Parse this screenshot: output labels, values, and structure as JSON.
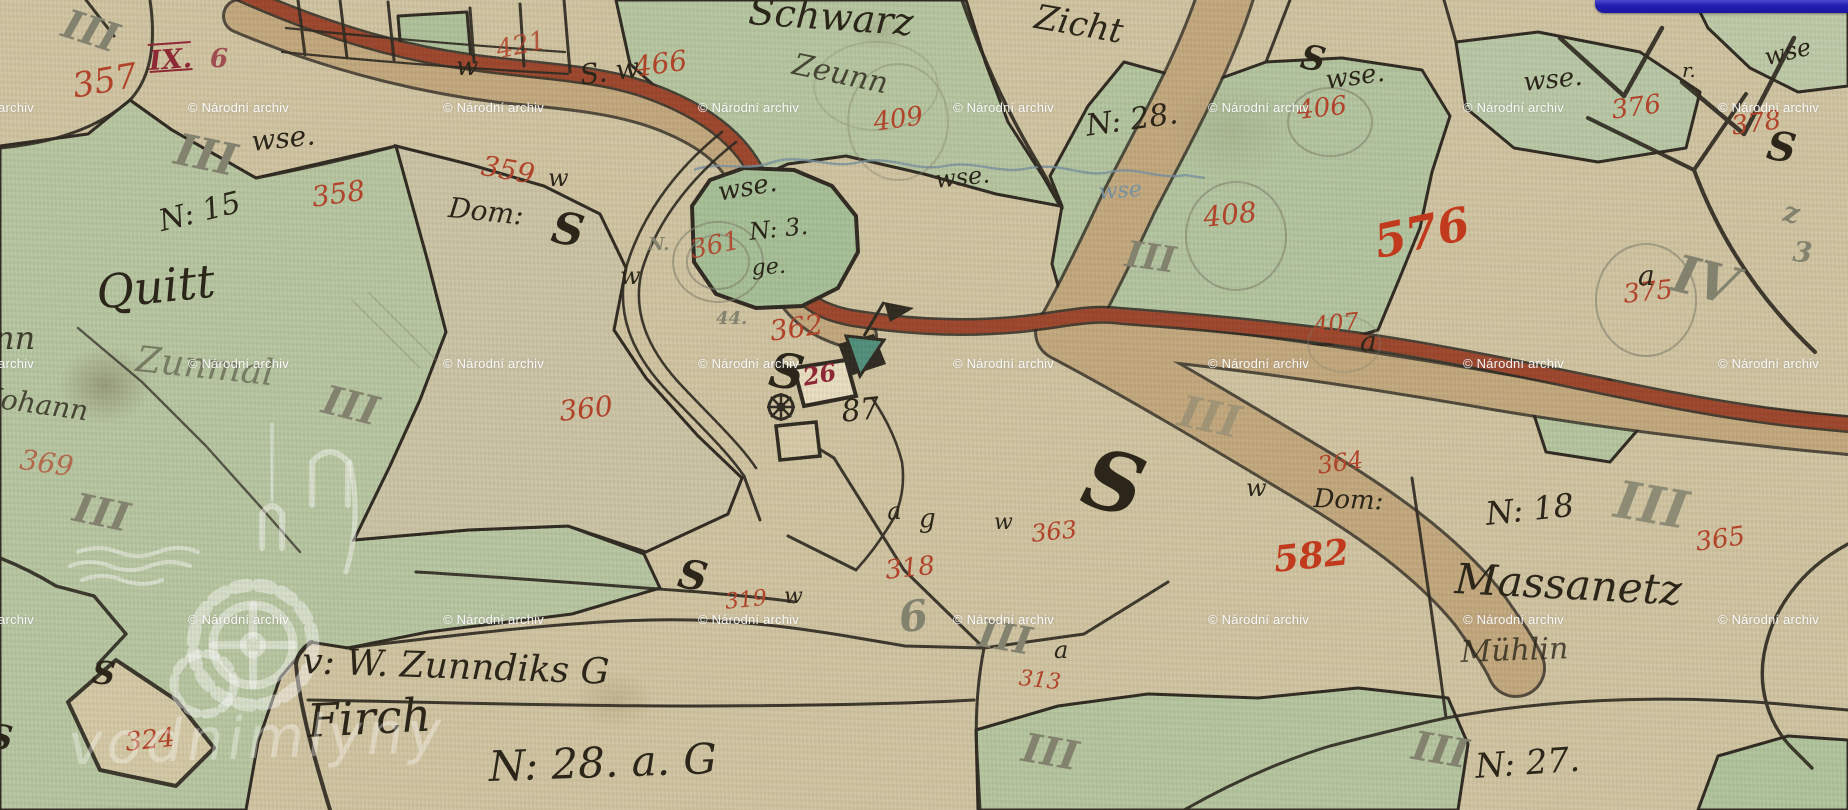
{
  "viewer": {
    "archive_watermark_text": "© Národní archiv",
    "logo_text": "vodnimlyny",
    "map_kind_note": "historic hand-drawn cadastral map sheet"
  },
  "watermark_grid": {
    "cols": [
      -67,
      188,
      443,
      698,
      953,
      1208,
      1463,
      1718
    ],
    "rows": [
      100,
      356,
      612
    ]
  },
  "colors": {
    "paper": "#d0c4a2",
    "field_green": "#b7c6a2",
    "pond_green": "#a6c098",
    "road_brick": "#9c452c",
    "road_tan": "#c2a87e",
    "ink": "#2b2619",
    "red_ink": "#b0432a",
    "bright_red_ink": "#c23a1d",
    "pencil": "#83826e",
    "stream_blue": "#76909f",
    "ui_blue_bar": "#221cae",
    "watermark_white": "#ffffff"
  },
  "map_labels": {
    "red": [
      {
        "t": "357",
        "x": 70,
        "y": 70,
        "s": 34,
        "r": -10
      },
      {
        "t": "IX.",
        "x": 148,
        "y": 48,
        "s": 27,
        "r": -4,
        "v": "dark rule"
      },
      {
        "t": "6",
        "x": 210,
        "y": 46,
        "s": 26,
        "r": 0,
        "v": "dark",
        "o": 0.75
      },
      {
        "t": "421",
        "x": 494,
        "y": 38,
        "s": 26,
        "r": -12,
        "o": 0.85
      },
      {
        "t": "466",
        "x": 632,
        "y": 54,
        "s": 28,
        "r": -8
      },
      {
        "t": "358",
        "x": 310,
        "y": 184,
        "s": 28,
        "r": -8
      },
      {
        "t": "359",
        "x": 484,
        "y": 152,
        "s": 28,
        "r": 10
      },
      {
        "t": "409",
        "x": 872,
        "y": 110,
        "s": 26,
        "r": -8
      },
      {
        "t": "406",
        "x": 1296,
        "y": 98,
        "s": 26,
        "r": -6
      },
      {
        "t": "408",
        "x": 1202,
        "y": 204,
        "s": 28,
        "r": -6
      },
      {
        "t": "361",
        "x": 688,
        "y": 238,
        "s": 26,
        "r": -12,
        "o": 0.9
      },
      {
        "t": "362",
        "x": 768,
        "y": 318,
        "s": 28,
        "r": -8
      },
      {
        "t": "360",
        "x": 558,
        "y": 398,
        "s": 28,
        "r": -6
      },
      {
        "t": "369",
        "x": 22,
        "y": 446,
        "s": 28,
        "r": 8,
        "o": 0.7
      },
      {
        "t": "576",
        "x": 1370,
        "y": 220,
        "s": 46,
        "r": -12,
        "v": "bright"
      },
      {
        "t": "407",
        "x": 1312,
        "y": 314,
        "s": 24,
        "r": -6
      },
      {
        "t": "375",
        "x": 1622,
        "y": 282,
        "s": 26,
        "r": -6
      },
      {
        "t": "376",
        "x": 1610,
        "y": 98,
        "s": 26,
        "r": -8
      },
      {
        "t": "378",
        "x": 1730,
        "y": 114,
        "s": 26,
        "r": -8
      },
      {
        "t": "364",
        "x": 1316,
        "y": 454,
        "s": 24,
        "r": -8
      },
      {
        "t": "363",
        "x": 1030,
        "y": 522,
        "s": 24,
        "r": -6
      },
      {
        "t": "582",
        "x": 1272,
        "y": 542,
        "s": 36,
        "r": -6,
        "v": "bright"
      },
      {
        "t": "365",
        "x": 1694,
        "y": 530,
        "s": 26,
        "r": -8
      },
      {
        "t": "318",
        "x": 884,
        "y": 558,
        "s": 26,
        "r": -6
      },
      {
        "t": "319",
        "x": 724,
        "y": 592,
        "s": 22,
        "r": -6
      },
      {
        "t": "313",
        "x": 1020,
        "y": 668,
        "s": 22,
        "r": 6
      },
      {
        "t": "324",
        "x": 124,
        "y": 730,
        "s": 26,
        "r": -6
      },
      {
        "t": "26",
        "x": 801,
        "y": 366,
        "s": 24,
        "r": -10,
        "v": "dark"
      }
    ],
    "ink": [
      {
        "t": "Schwarz",
        "x": 750,
        "y": -8,
        "s": 38,
        "r": 4
      },
      {
        "t": "Zicht",
        "x": 1038,
        "y": 0,
        "s": 34,
        "r": 10
      },
      {
        "t": "Zeunn",
        "x": 796,
        "y": 50,
        "s": 30,
        "r": 12,
        "o": 0.8
      },
      {
        "t": "wse.",
        "x": 250,
        "y": 128,
        "s": 28,
        "r": -6
      },
      {
        "t": "N: 15",
        "x": 156,
        "y": 208,
        "s": 30,
        "r": -14
      },
      {
        "t": "Quitt",
        "x": 94,
        "y": 270,
        "s": 46,
        "r": -6
      },
      {
        "t": "Dom:",
        "x": 450,
        "y": 194,
        "s": 28,
        "r": 6
      },
      {
        "t": "w",
        "x": 456,
        "y": 54,
        "s": 26,
        "r": 0
      },
      {
        "t": "S. w",
        "x": 578,
        "y": 62,
        "s": 28,
        "r": -8
      },
      {
        "t": "w",
        "x": 548,
        "y": 166,
        "s": 24,
        "r": 0
      },
      {
        "t": "wse.",
        "x": 716,
        "y": 180,
        "s": 26,
        "r": -10
      },
      {
        "t": "N: 3.",
        "x": 748,
        "y": 220,
        "s": 24,
        "r": -6
      },
      {
        "t": "ge.",
        "x": 751,
        "y": 258,
        "s": 22,
        "r": -4
      },
      {
        "t": "w",
        "x": 620,
        "y": 264,
        "s": 24,
        "r": 0
      },
      {
        "t": "wse.",
        "x": 934,
        "y": 168,
        "s": 24,
        "r": -6
      },
      {
        "t": "N: 28.",
        "x": 1084,
        "y": 112,
        "s": 30,
        "r": -8
      },
      {
        "t": "wse.",
        "x": 1324,
        "y": 68,
        "s": 26,
        "r": -8
      },
      {
        "t": "wse.",
        "x": 1522,
        "y": 70,
        "s": 26,
        "r": -6
      },
      {
        "t": "wse",
        "x": 1762,
        "y": 46,
        "s": 24,
        "r": -14
      },
      {
        "t": "r.",
        "x": 1682,
        "y": 60,
        "s": 20,
        "r": 0
      },
      {
        "t": "a",
        "x": 1638,
        "y": 262,
        "s": 28,
        "r": 0
      },
      {
        "t": "a",
        "x": 1360,
        "y": 328,
        "s": 28,
        "r": 0
      },
      {
        "t": "w",
        "x": 1246,
        "y": 476,
        "s": 24,
        "r": 0
      },
      {
        "t": "Dom:",
        "x": 1314,
        "y": 486,
        "s": 26,
        "r": 2
      },
      {
        "t": "w",
        "x": 994,
        "y": 512,
        "s": 22,
        "r": 0
      },
      {
        "t": "87",
        "x": 840,
        "y": 398,
        "s": 30,
        "r": -6
      },
      {
        "t": "a",
        "x": 886,
        "y": 500,
        "s": 24,
        "r": -5
      },
      {
        "t": "g",
        "x": 919,
        "y": 506,
        "s": 26,
        "r": 0
      },
      {
        "t": "a",
        "x": 1054,
        "y": 638,
        "s": 24,
        "r": 0
      },
      {
        "t": "N: 18",
        "x": 1484,
        "y": 498,
        "s": 32,
        "r": -6
      },
      {
        "t": "Massanetz",
        "x": 1456,
        "y": 558,
        "s": 42,
        "r": 3
      },
      {
        "t": "Mühlin",
        "x": 1460,
        "y": 638,
        "s": 30,
        "r": -2,
        "o": 0.8
      },
      {
        "t": "N: 27.",
        "x": 1474,
        "y": 750,
        "s": 34,
        "r": -4
      },
      {
        "t": "v: W. Zunndiks G",
        "x": 303,
        "y": 644,
        "s": 36,
        "r": 2
      },
      {
        "t": "Firch",
        "x": 306,
        "y": 698,
        "s": 46,
        "r": -3
      },
      {
        "t": "N: 28. a. G",
        "x": 488,
        "y": 746,
        "s": 42,
        "r": -2
      },
      {
        "t": "Johann",
        "x": -8,
        "y": 384,
        "s": 28,
        "r": 8,
        "o": 0.8
      },
      {
        "t": "nn",
        "x": -6,
        "y": 322,
        "s": 32,
        "r": 0,
        "o": 0.85
      },
      {
        "t": "w",
        "x": 784,
        "y": 586,
        "s": 22,
        "r": 0
      },
      {
        "t": "Zunmal",
        "x": 138,
        "y": 342,
        "s": 36,
        "r": 6,
        "o": 0.45
      }
    ],
    "flourish": [
      {
        "t": "S",
        "x": 556,
        "y": 206,
        "s": 44,
        "r": 10
      },
      {
        "t": "S",
        "x": 773,
        "y": 346,
        "s": 48,
        "r": 8
      },
      {
        "t": "S",
        "x": 682,
        "y": 554,
        "s": 40,
        "r": 10
      },
      {
        "t": "S",
        "x": 1096,
        "y": 436,
        "s": 82,
        "r": 15
      },
      {
        "t": "S",
        "x": 1304,
        "y": 40,
        "s": 34,
        "r": 10
      },
      {
        "t": "S",
        "x": 1770,
        "y": 126,
        "s": 40,
        "r": 8
      },
      {
        "t": "S",
        "x": 94,
        "y": 656,
        "s": 32,
        "r": 6
      },
      {
        "t": "S",
        "x": -10,
        "y": 720,
        "s": 34,
        "r": 6
      }
    ],
    "pencil": [
      {
        "t": "III",
        "x": 70,
        "y": 4,
        "s": 40,
        "r": 18
      },
      {
        "t": "III",
        "x": 180,
        "y": 128,
        "s": 44,
        "r": 12
      },
      {
        "t": "III",
        "x": 328,
        "y": 380,
        "s": 40,
        "r": 14
      },
      {
        "t": "III",
        "x": 78,
        "y": 488,
        "s": 40,
        "r": 12
      },
      {
        "t": "III",
        "x": 982,
        "y": 614,
        "s": 38,
        "r": 10
      },
      {
        "t": "III",
        "x": 1128,
        "y": 236,
        "s": 36,
        "r": 8
      },
      {
        "t": "III",
        "x": 1620,
        "y": 474,
        "s": 52,
        "r": 10,
        "o": 0.85
      },
      {
        "t": "III",
        "x": 1416,
        "y": 726,
        "s": 40,
        "r": 10
      },
      {
        "t": "III",
        "x": 1026,
        "y": 728,
        "s": 40,
        "r": 10
      },
      {
        "t": "III",
        "x": 1184,
        "y": 390,
        "s": 44,
        "r": 12,
        "o": 0.5
      },
      {
        "t": "IV",
        "x": 1680,
        "y": 248,
        "s": 52,
        "r": 14
      },
      {
        "t": "44.",
        "x": 716,
        "y": 310,
        "s": 18,
        "r": 0
      },
      {
        "t": "N.",
        "x": 648,
        "y": 236,
        "s": 18,
        "r": 0
      },
      {
        "t": "6",
        "x": 896,
        "y": 598,
        "s": 42,
        "r": -8
      },
      {
        "t": "z",
        "x": 1786,
        "y": 198,
        "s": 28,
        "r": 10
      },
      {
        "t": "3",
        "x": 1794,
        "y": 238,
        "s": 28,
        "r": 5
      }
    ],
    "blue": [
      {
        "t": "wse",
        "x": 1098,
        "y": 182,
        "s": 22,
        "r": -4
      }
    ]
  }
}
